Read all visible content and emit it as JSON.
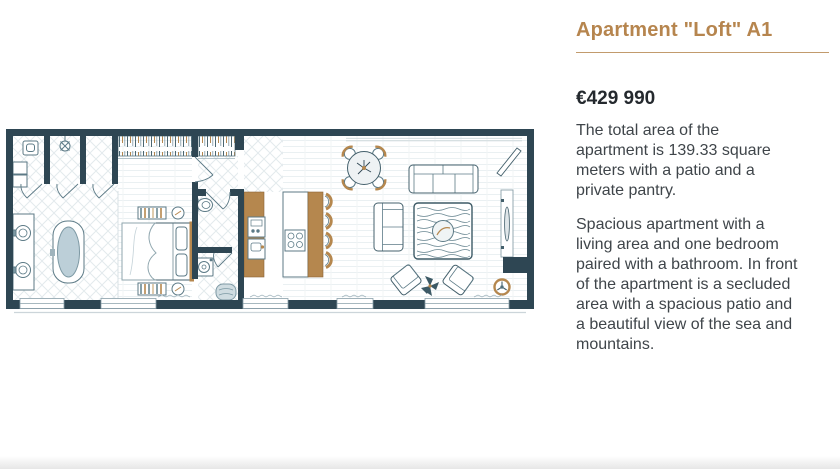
{
  "listing": {
    "title": "Apartment \"Loft\" A1",
    "price": "€429 990",
    "paragraph1": "The total area of the\napartment is 139.33 square\nmeters with a patio and a\nprivate pantry.",
    "paragraph2": "Spacious apartment with a\nliving area and one bedroom\npaired with a bathroom. In front\nof the apartment is a secluded\narea with a spacious patio and\na beautiful view of the sea and\nmountains."
  },
  "colors": {
    "accent_gold": "#b5874e",
    "wall_dark": "#2e4653",
    "furniture_line": "#5c7a86",
    "tub_fill": "#bccfd8",
    "title_text": "#b6854e",
    "body_text": "#3f454a",
    "price_text": "#24292e"
  }
}
